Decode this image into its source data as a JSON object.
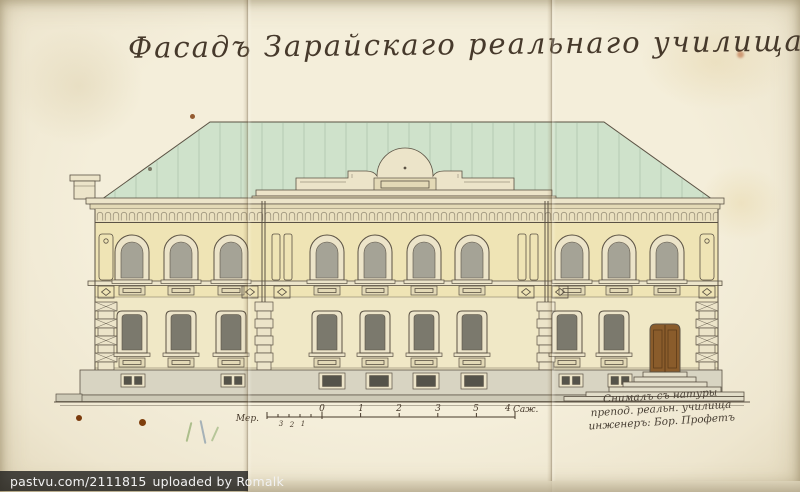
{
  "title": "Фасадъ Зарайскаго реальнаго училища.",
  "scale_bar": {
    "label": "Мер.",
    "sub_ticks": [
      "3",
      "2",
      "1"
    ],
    "ticks": [
      "0",
      "1",
      "2",
      "3",
      "4"
    ],
    "end_tick": "5",
    "unit": "Саж."
  },
  "inscription": {
    "line1": "Снималъ съ натуры",
    "line2": "препод. реальн. училища",
    "line3": "инженеръ: Бор. Профетъ"
  },
  "watermark": {
    "site": "pastvu.com/2111815",
    "uploaded": "uploaded by Romalk"
  },
  "colors": {
    "paper": "#f1ead7",
    "ink": "#5b5244",
    "ink_text": "#46392b",
    "roof": "#cfe2cb",
    "roof_seam": "#9ab49a",
    "wall_upper": "#efe4b5",
    "wall_lower": "#f0e8c6",
    "frieze": "#eae0bf",
    "cornice": "#ece4c9",
    "cornice2": "#e3d9b6",
    "frame": "#ece4c9",
    "glass_upper": "#a5a396",
    "glass_lower": "#7b796d",
    "glass_dark": "#55534a",
    "plinth": "#d8d4c2",
    "plinth2": "#cdc9b6",
    "step": "#e2ddc9",
    "door": "#8a5c2b",
    "door_dark": "#5e3d1a",
    "watermark_bg": "rgba(25,25,25,0.78)",
    "watermark_text": "#f2f2f2"
  }
}
